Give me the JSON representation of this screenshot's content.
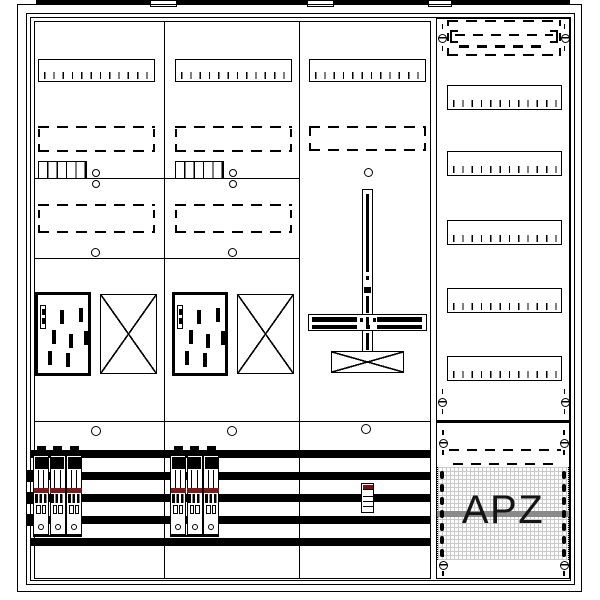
{
  "drawing": {
    "apz_label": "APZ",
    "colors": {
      "line": "#000000",
      "breaker_stripe": "#7b1b1b",
      "device_cap": "#7a1212",
      "apz_band": "#8a8a8a",
      "grid_texture": "#c9c9c9"
    },
    "components": {
      "top_flange_segments": 4,
      "columns": 4,
      "din_rails_left_section": 3,
      "din_rails_right_column": 5,
      "dashed_reserved_areas": 7,
      "meter_mounting_plates": 2,
      "blanked_x_fields": 3,
      "busbars": 5,
      "breaker_groups": 2,
      "poles_per_breaker_group": 3,
      "mounting_holes": 10,
      "screws": 8
    }
  }
}
